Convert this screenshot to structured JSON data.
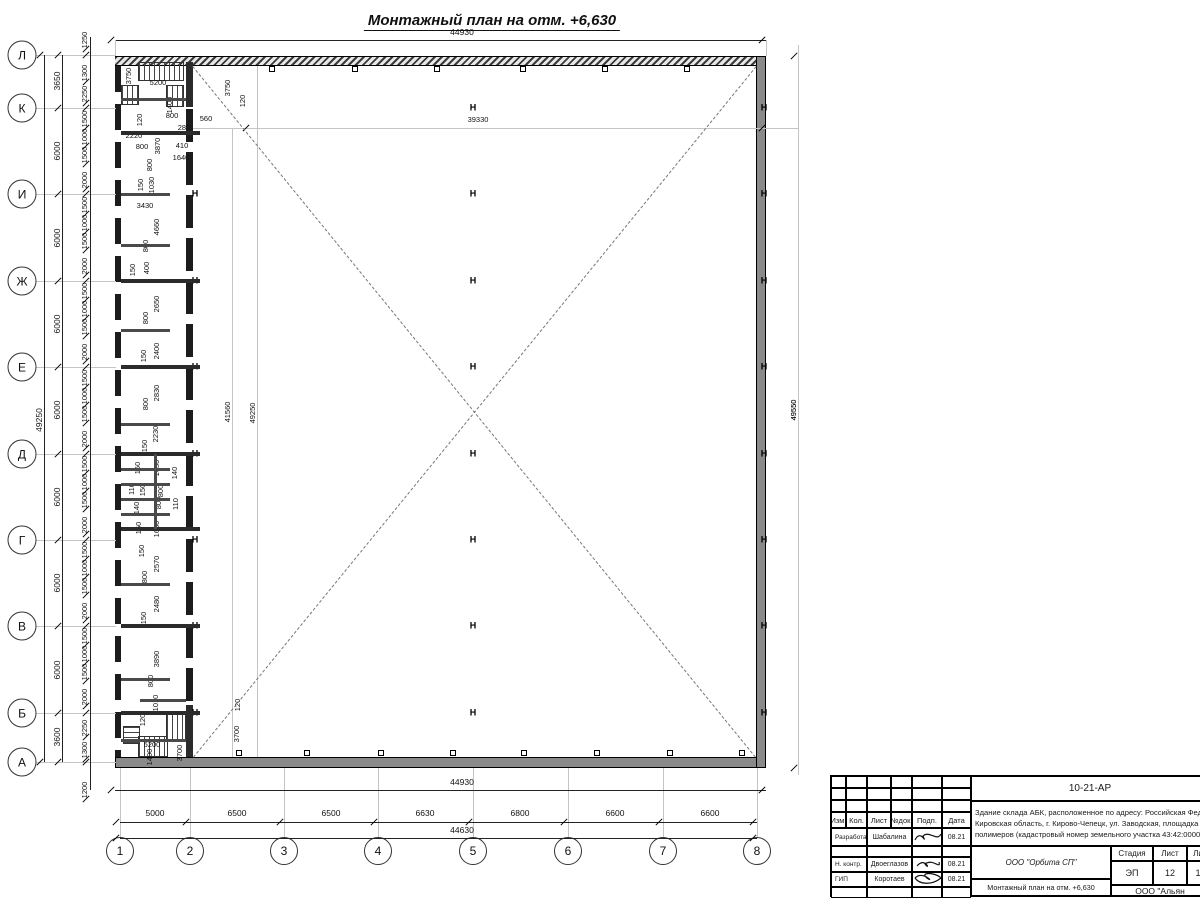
{
  "drawing": {
    "title": "Монтажный план на отм. +6,630",
    "column_mark_glyph": "H"
  },
  "axes": {
    "rows": [
      {
        "label": "Л",
        "y": 55
      },
      {
        "label": "К",
        "y": 108
      },
      {
        "label": "И",
        "y": 194
      },
      {
        "label": "Ж",
        "y": 281
      },
      {
        "label": "Е",
        "y": 367
      },
      {
        "label": "Д",
        "y": 454
      },
      {
        "label": "Г",
        "y": 540
      },
      {
        "label": "В",
        "y": 626
      },
      {
        "label": "Б",
        "y": 713
      },
      {
        "label": "А",
        "y": 762
      }
    ],
    "cols": [
      {
        "label": "1",
        "x": 120
      },
      {
        "label": "2",
        "x": 190
      },
      {
        "label": "3",
        "x": 284
      },
      {
        "label": "4",
        "x": 378
      },
      {
        "label": "5",
        "x": 473
      },
      {
        "label": "6",
        "x": 568
      },
      {
        "label": "7",
        "x": 663
      },
      {
        "label": "8",
        "x": 757
      }
    ]
  },
  "dimensions": {
    "top_total": "44930",
    "bottom_wall_total": "44930",
    "bottom_overall": "44630",
    "left_overall": "49250",
    "right_overall": "49550",
    "bottom_segments": [
      {
        "t": "5000",
        "x": 155
      },
      {
        "t": "6500",
        "x": 237
      },
      {
        "t": "6500",
        "x": 331
      },
      {
        "t": "6630",
        "x": 425
      },
      {
        "t": "6800",
        "x": 520
      },
      {
        "t": "6600",
        "x": 615
      },
      {
        "t": "6600",
        "x": 710
      }
    ],
    "left_coarse": [
      {
        "t": "3650",
        "y": 81
      },
      {
        "t": "6000",
        "y": 151
      },
      {
        "t": "6000",
        "y": 238
      },
      {
        "t": "6000",
        "y": 324
      },
      {
        "t": "6000",
        "y": 410
      },
      {
        "t": "6000",
        "y": 497
      },
      {
        "t": "6000",
        "y": 583
      },
      {
        "t": "6000",
        "y": 670
      },
      {
        "t": "3600",
        "y": 737
      }
    ],
    "left_fine": [
      {
        "t": "1250",
        "y": 40
      },
      {
        "t": "1300",
        "y": 73
      },
      {
        "t": "2250",
        "y": 94
      },
      {
        "t": "1500",
        "y": 119
      },
      {
        "t": "1000",
        "y": 137
      },
      {
        "t": "1500",
        "y": 155
      },
      {
        "t": "2000",
        "y": 180
      },
      {
        "t": "1500",
        "y": 205
      },
      {
        "t": "1000",
        "y": 223
      },
      {
        "t": "1500",
        "y": 241
      },
      {
        "t": "2000",
        "y": 266
      },
      {
        "t": "1500",
        "y": 291
      },
      {
        "t": "1000",
        "y": 309
      },
      {
        "t": "1500",
        "y": 327
      },
      {
        "t": "2000",
        "y": 352
      },
      {
        "t": "1500",
        "y": 378
      },
      {
        "t": "1000",
        "y": 396
      },
      {
        "t": "1500",
        "y": 414
      },
      {
        "t": "2000",
        "y": 439
      },
      {
        "t": "1500",
        "y": 464
      },
      {
        "t": "1000",
        "y": 482
      },
      {
        "t": "1500",
        "y": 500
      },
      {
        "t": "2000",
        "y": 525
      },
      {
        "t": "1500",
        "y": 550
      },
      {
        "t": "1000",
        "y": 568
      },
      {
        "t": "1500",
        "y": 586
      },
      {
        "t": "2000",
        "y": 611
      },
      {
        "t": "1500",
        "y": 636
      },
      {
        "t": "1000",
        "y": 654
      },
      {
        "t": "1500",
        "y": 672
      },
      {
        "t": "2000",
        "y": 697
      },
      {
        "t": "2250",
        "y": 728
      },
      {
        "t": "1300",
        "y": 750
      },
      {
        "t": "1200",
        "y": 790
      }
    ],
    "interior": [
      {
        "t": "39330",
        "x": 478,
        "y": 120,
        "r": false
      },
      {
        "t": "41560",
        "x": 228,
        "y": 412,
        "r": true
      },
      {
        "t": "49250",
        "x": 253,
        "y": 413,
        "r": true
      },
      {
        "t": "49550",
        "x": 794,
        "y": 410,
        "r": true
      }
    ],
    "strip": [
      {
        "t": "3750",
        "x": 129,
        "y": 76,
        "r": true
      },
      {
        "t": "5200",
        "x": 158,
        "y": 83,
        "r": false
      },
      {
        "t": "1400",
        "x": 170,
        "y": 105,
        "r": true
      },
      {
        "t": "120",
        "x": 140,
        "y": 120,
        "r": true
      },
      {
        "t": "800",
        "x": 172,
        "y": 116,
        "r": false
      },
      {
        "t": "280",
        "x": 184,
        "y": 128,
        "r": false
      },
      {
        "t": "560",
        "x": 206,
        "y": 119,
        "r": false
      },
      {
        "t": "2220",
        "x": 134,
        "y": 136,
        "r": false
      },
      {
        "t": "800",
        "x": 142,
        "y": 147,
        "r": false
      },
      {
        "t": "3870",
        "x": 158,
        "y": 146,
        "r": true
      },
      {
        "t": "410",
        "x": 182,
        "y": 146,
        "r": false
      },
      {
        "t": "1640",
        "x": 181,
        "y": 158,
        "r": false
      },
      {
        "t": "800",
        "x": 150,
        "y": 165,
        "r": true
      },
      {
        "t": "150",
        "x": 141,
        "y": 185,
        "r": true
      },
      {
        "t": "1030",
        "x": 152,
        "y": 185,
        "r": true
      },
      {
        "t": "3430",
        "x": 145,
        "y": 206,
        "r": false
      },
      {
        "t": "4660",
        "x": 157,
        "y": 227,
        "r": true
      },
      {
        "t": "800",
        "x": 146,
        "y": 246,
        "r": true
      },
      {
        "t": "400",
        "x": 147,
        "y": 268,
        "r": true
      },
      {
        "t": "150",
        "x": 133,
        "y": 270,
        "r": true
      },
      {
        "t": "2650",
        "x": 157,
        "y": 304,
        "r": true
      },
      {
        "t": "800",
        "x": 146,
        "y": 318,
        "r": true
      },
      {
        "t": "2400",
        "x": 157,
        "y": 351,
        "r": true
      },
      {
        "t": "150",
        "x": 144,
        "y": 356,
        "r": true
      },
      {
        "t": "2830",
        "x": 157,
        "y": 393,
        "r": true
      },
      {
        "t": "800",
        "x": 146,
        "y": 404,
        "r": true
      },
      {
        "t": "2230",
        "x": 156,
        "y": 434,
        "r": true
      },
      {
        "t": "150",
        "x": 145,
        "y": 446,
        "r": true
      },
      {
        "t": "1650",
        "x": 157,
        "y": 468,
        "r": true
      },
      {
        "t": "150",
        "x": 138,
        "y": 468,
        "r": true
      },
      {
        "t": "140",
        "x": 175,
        "y": 473,
        "r": true
      },
      {
        "t": "110",
        "x": 132,
        "y": 489,
        "r": true
      },
      {
        "t": "150",
        "x": 143,
        "y": 490,
        "r": true
      },
      {
        "t": "800",
        "x": 161,
        "y": 491,
        "r": true
      },
      {
        "t": "140",
        "x": 137,
        "y": 508,
        "r": true
      },
      {
        "t": "800",
        "x": 159,
        "y": 503,
        "r": true
      },
      {
        "t": "110",
        "x": 176,
        "y": 504,
        "r": true
      },
      {
        "t": "150",
        "x": 139,
        "y": 528,
        "r": true
      },
      {
        "t": "1650",
        "x": 157,
        "y": 529,
        "r": true
      },
      {
        "t": "150",
        "x": 142,
        "y": 551,
        "r": true
      },
      {
        "t": "2570",
        "x": 157,
        "y": 564,
        "r": true
      },
      {
        "t": "800",
        "x": 145,
        "y": 577,
        "r": true
      },
      {
        "t": "2480",
        "x": 157,
        "y": 604,
        "r": true
      },
      {
        "t": "150",
        "x": 144,
        "y": 618,
        "r": true
      },
      {
        "t": "3890",
        "x": 157,
        "y": 659,
        "r": true
      },
      {
        "t": "800",
        "x": 151,
        "y": 681,
        "r": true
      },
      {
        "t": "1010",
        "x": 156,
        "y": 703,
        "r": true
      },
      {
        "t": "120",
        "x": 143,
        "y": 720,
        "r": true
      },
      {
        "t": "5200",
        "x": 152,
        "y": 745,
        "r": false
      },
      {
        "t": "1400",
        "x": 150,
        "y": 757,
        "r": true
      },
      {
        "t": "3700",
        "x": 180,
        "y": 753,
        "r": true
      },
      {
        "t": "120",
        "x": 238,
        "y": 705,
        "r": true
      },
      {
        "t": "3700",
        "x": 237,
        "y": 734,
        "r": true
      },
      {
        "t": "3750",
        "x": 228,
        "y": 88,
        "r": true
      },
      {
        "t": "120",
        "x": 243,
        "y": 101,
        "r": true
      }
    ]
  },
  "titleblock": {
    "doc_code": "10-21-АР",
    "desc_line1": "Здание склада АБК, расположенное по адресу: Российская Феде",
    "desc_line2": "Кировская область, г. Кирово-Чепецк, ул. Заводская, площадка з",
    "desc_line3": "полимеров (кадастровый номер земельного участка 43:42:0000",
    "header_cells": [
      "Изм.",
      "Кол.",
      "Лист",
      "№док.",
      "Подп.",
      "Дата"
    ],
    "rows": [
      {
        "role": "Разработал",
        "name": "Шабалина",
        "date": "08.21"
      },
      {
        "role": "Н. контр.",
        "name": "Двоеглазов",
        "date": "08.21"
      },
      {
        "role": "ГИП",
        "name": "Коротаев",
        "date": "08.21"
      }
    ],
    "org": "ООО \"Орбита СП\"",
    "sheet_title": "Монтажный план на отм. +6,630",
    "stage_label": "Стадия",
    "sheet_label": "Лист",
    "sheets_label": "Ли",
    "stage": "ЭП",
    "sheet_no": "12",
    "sheets_no": "1",
    "company2": "ООО \"Альян"
  }
}
